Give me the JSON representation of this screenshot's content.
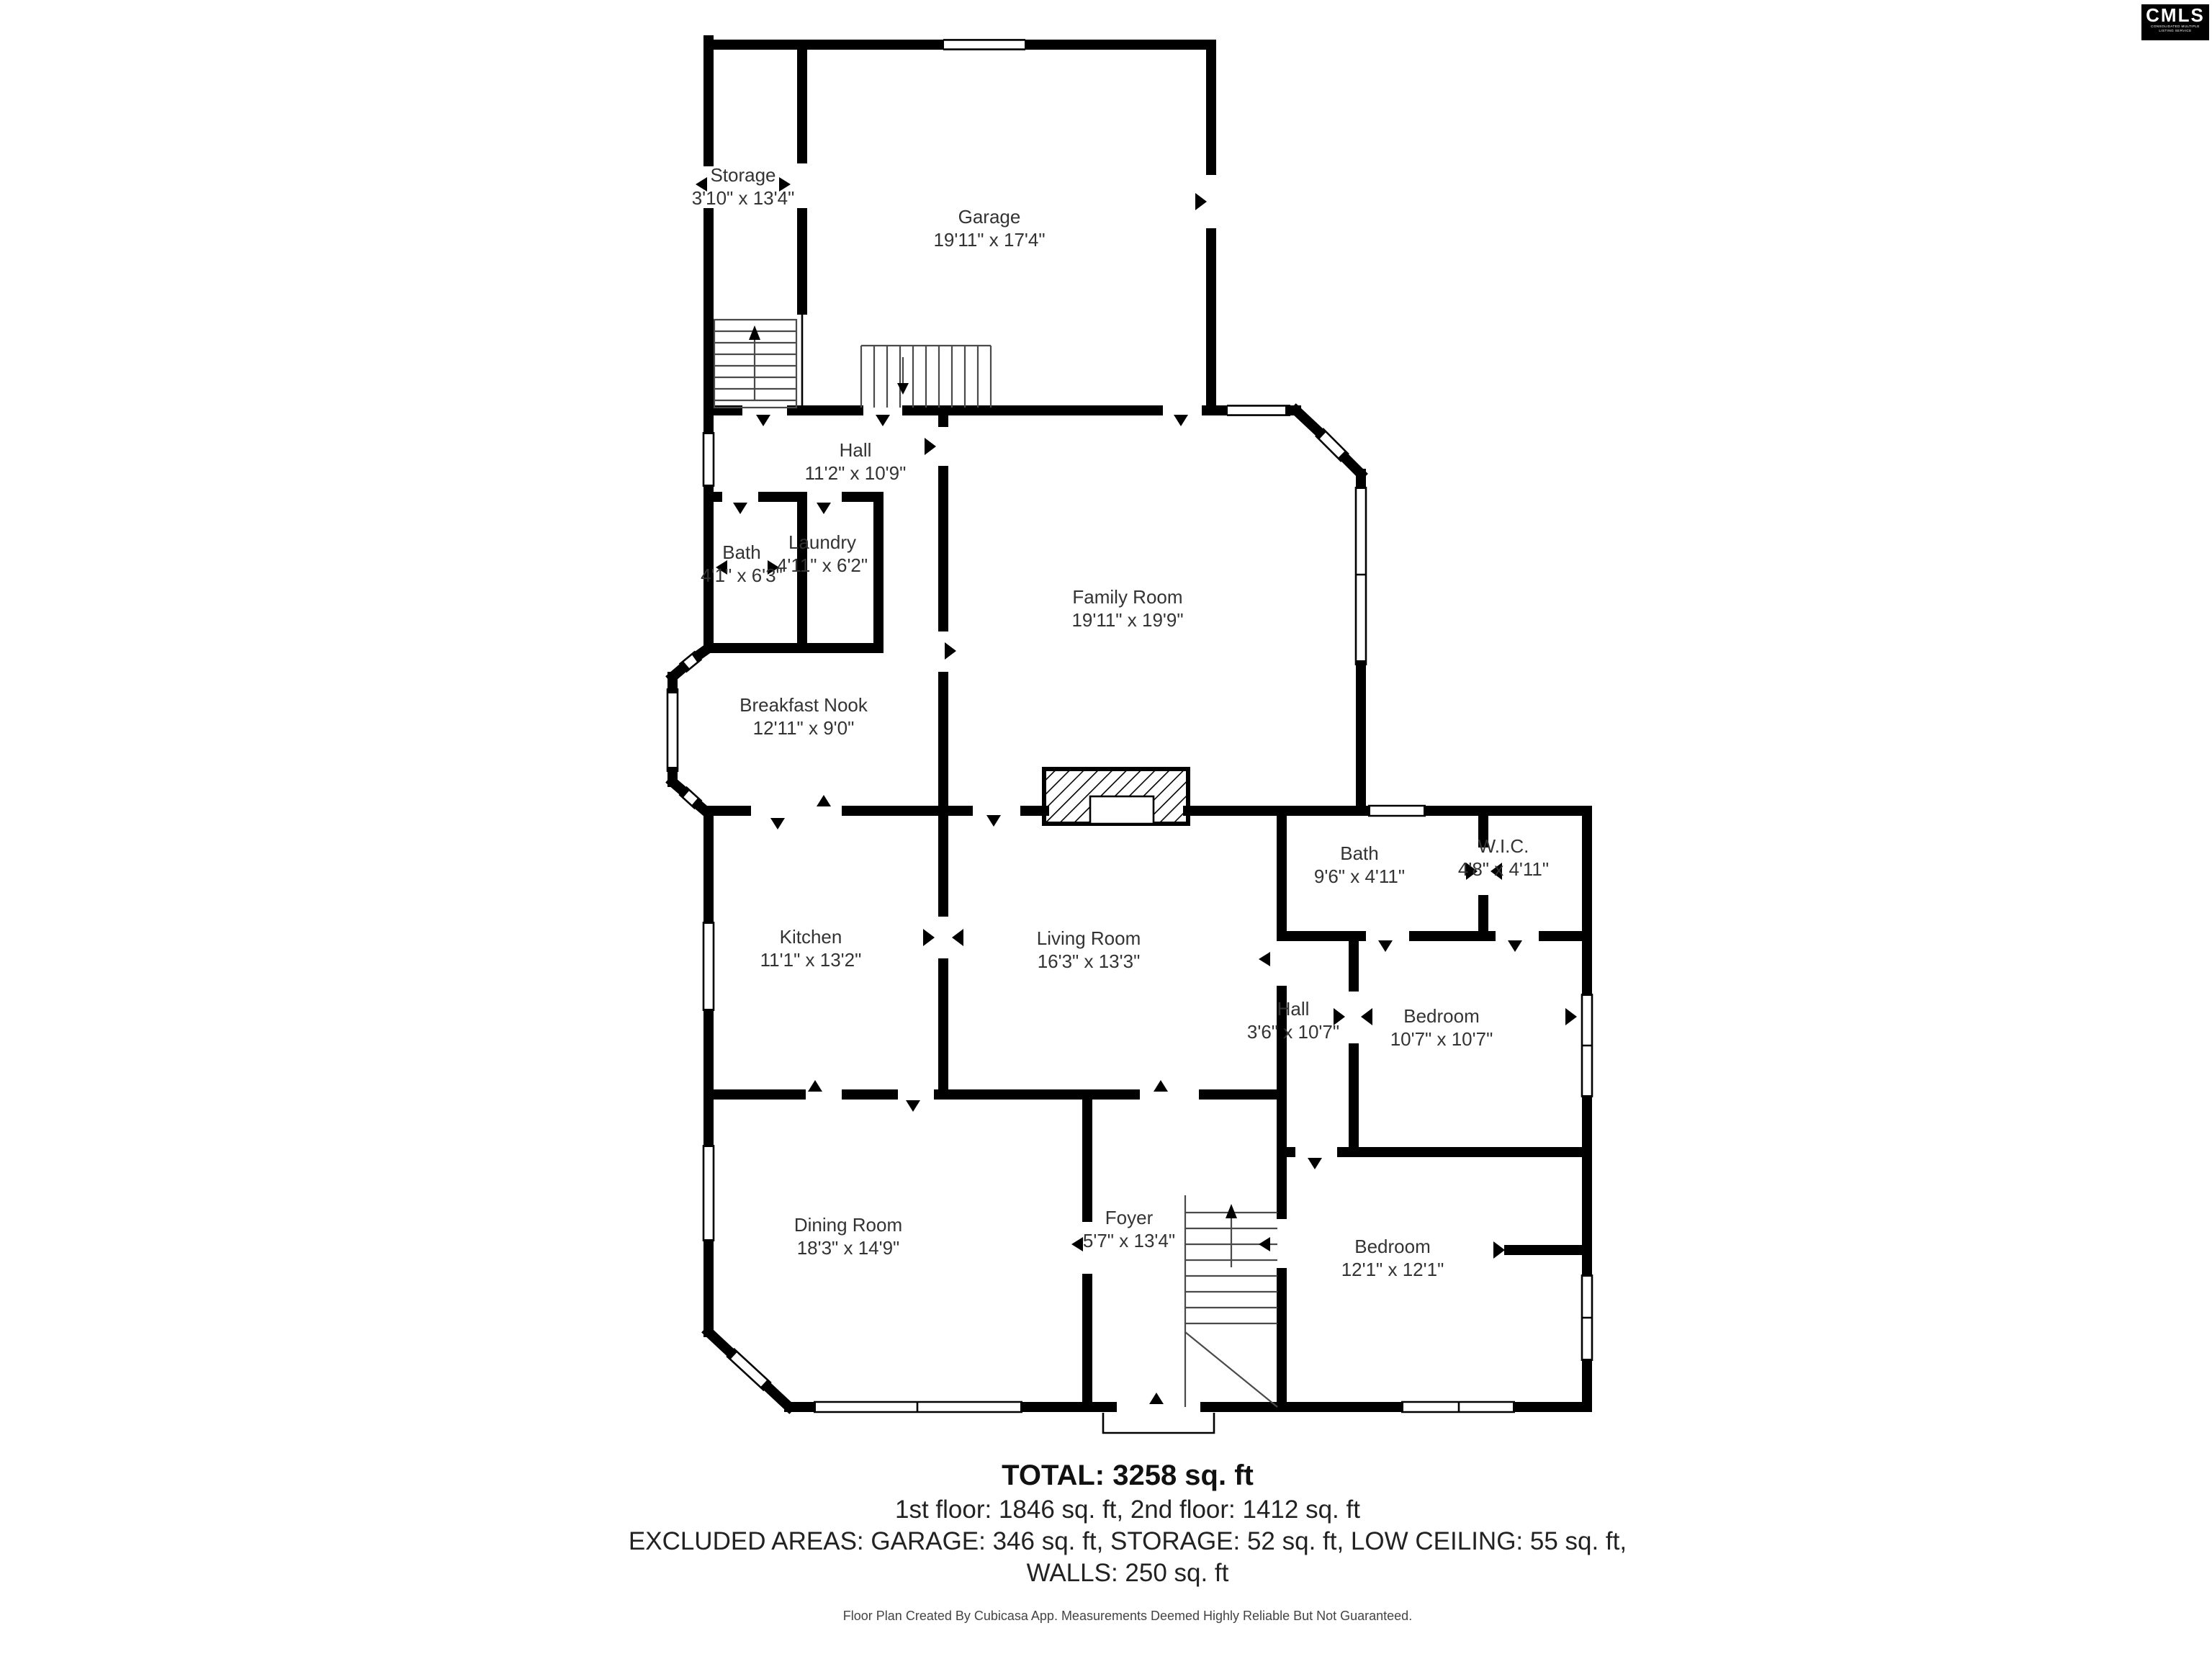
{
  "logo": {
    "text": "CMLS",
    "subtext": "CONSOLIDATED MULTIPLE LISTING SERVICE"
  },
  "rooms": {
    "storage": {
      "name": "Storage",
      "dims": "3'10\" x 13'4\""
    },
    "garage": {
      "name": "Garage",
      "dims": "19'11\" x 17'4\""
    },
    "hall": {
      "name": "Hall",
      "dims": "11'2\" x 10'9\""
    },
    "bath": {
      "name": "Bath",
      "dims": "4'1\" x 6'3\""
    },
    "laundry": {
      "name": "Laundry",
      "dims": "4'11\" x 6'2\""
    },
    "family": {
      "name": "Family Room",
      "dims": "19'11\" x 19'9\""
    },
    "nook": {
      "name": "Breakfast Nook",
      "dims": "12'11\" x 9'0\""
    },
    "kitchen": {
      "name": "Kitchen",
      "dims": "11'1\" x 13'2\""
    },
    "living": {
      "name": "Living Room",
      "dims": "16'3\" x 13'3\""
    },
    "bath2": {
      "name": "Bath",
      "dims": "9'6\" x 4'11\""
    },
    "wic": {
      "name": "W.I.C.",
      "dims": "4'8\" x 4'11\""
    },
    "hall2": {
      "name": "Hall",
      "dims": "3'6\" x 10'7\""
    },
    "bedroom1": {
      "name": "Bedroom",
      "dims": "10'7\" x 10'7\""
    },
    "dining": {
      "name": "Dining Room",
      "dims": "18'3\" x 14'9\""
    },
    "foyer": {
      "name": "Foyer",
      "dims": "5'7\" x 13'4\""
    },
    "bedroom2": {
      "name": "Bedroom",
      "dims": "12'1\" x 12'1\""
    }
  },
  "summary": {
    "total": "TOTAL: 3258 sq. ft",
    "floors": "1st floor: 1846 sq. ft, 2nd floor: 1412 sq. ft",
    "excluded": "EXCLUDED AREAS: GARAGE: 346 sq. ft, STORAGE: 52 sq. ft, LOW CEILING: 55 sq. ft,",
    "walls": "WALLS: 250 sq. ft"
  },
  "footer": "Floor Plan Created By Cubicasa App. Measurements Deemed Highly Reliable But Not Guaranteed.",
  "colors": {
    "wall": "#000000",
    "background": "#ffffff",
    "text": "#333333"
  }
}
